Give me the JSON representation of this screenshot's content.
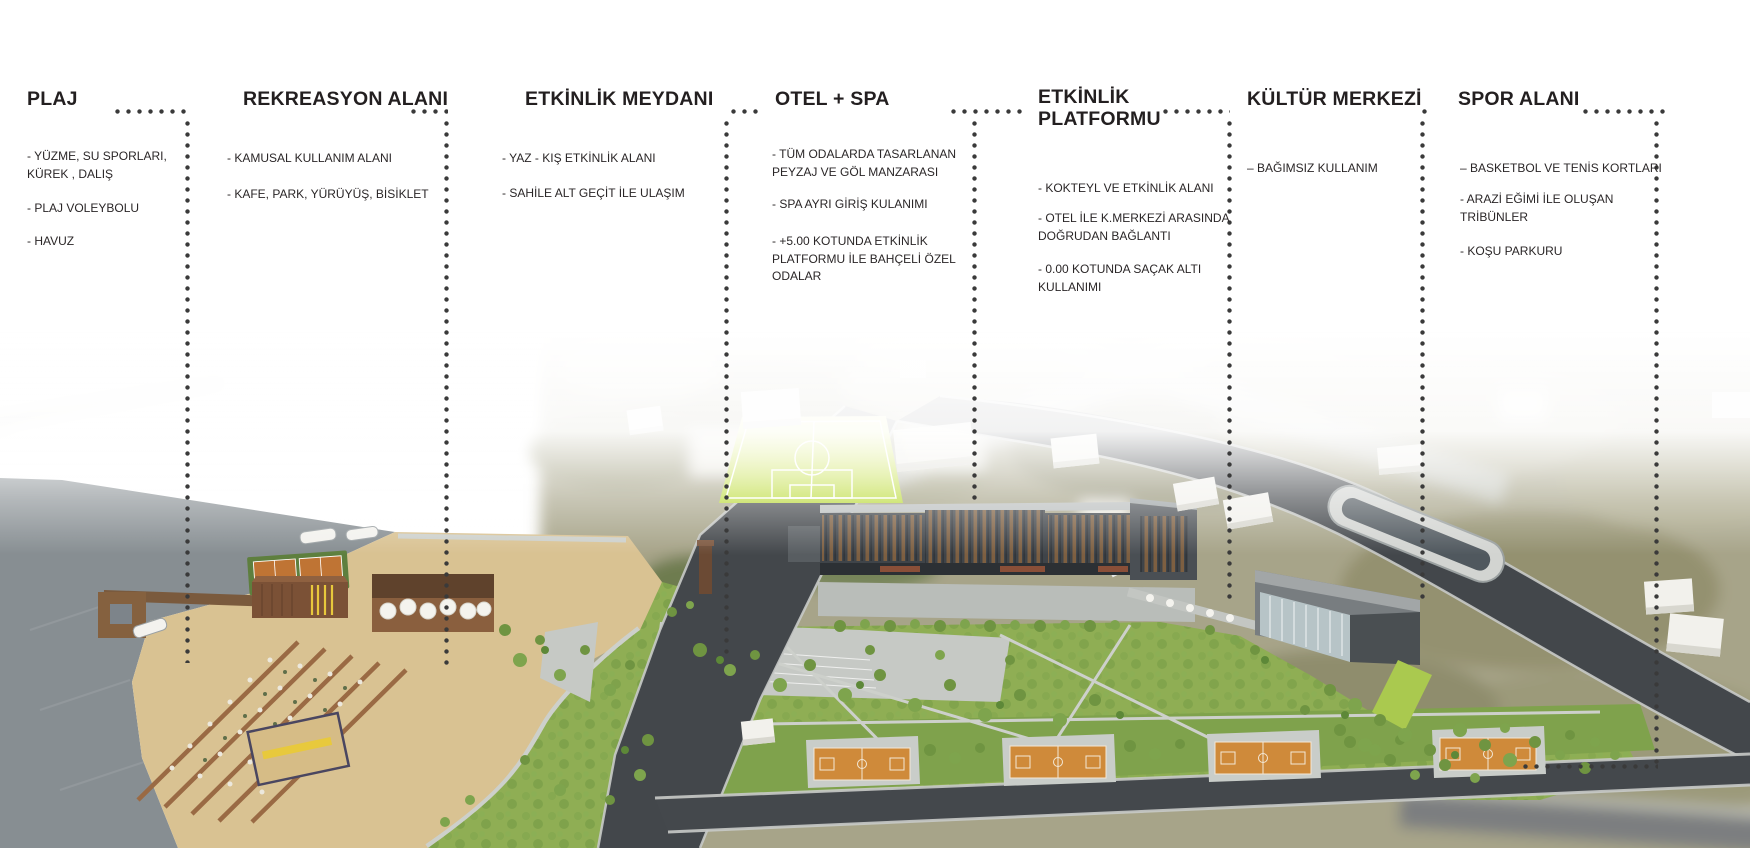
{
  "figure_type": "architectural-masterplan-diagram",
  "palette": {
    "text": "#231f20",
    "leader_dots": "#3a3a3a",
    "water": "#878e92",
    "sand": "#d9c292",
    "lawn": "#8fae54",
    "tree": "#6f9441",
    "road": "#43474b",
    "road_edge": "#c8cac8",
    "soccer_field": "#bfdb38",
    "court_orange": "#cf8a3a",
    "hotel_facade": "#3f4449",
    "hotel_windows": "#7d5f41",
    "culture_roof": "#9b9fa0",
    "white_building": "#f2f1ec",
    "plaza": "#c6c9c5",
    "deck_brown": "#8a5f3e",
    "terrain": "#a7a489"
  },
  "legend": {
    "sections": [
      {
        "title": "PLAJ",
        "items": [
          "- YÜZME, SU SPORLARI,\nKÜREK , DALIŞ",
          "- PLAJ VOLEYBOLU",
          "- HAVUZ"
        ]
      },
      {
        "title": "REKREASYON ALANI",
        "items": [
          "-  KAMUSAL KULLANIM ALANI",
          "- KAFE, PARK, YÜRÜYÜŞ, BİSİKLET"
        ]
      },
      {
        "title": "ETKİNLİK MEYDANI",
        "items": [
          "- YAZ - KIŞ ETKİNLİK ALANI",
          "- SAHİLE ALT GEÇİT İLE ULAŞIM"
        ]
      },
      {
        "title": "OTEL + SPA",
        "items": [
          "-  TÜM ODALARDA  TASARLANAN\nPEYZAJ VE GÖL MANZARASI",
          "- SPA AYRI GİRİŞ KULANIMI",
          "- +5.00 KOTUNDA ETKİNLİK\nPLATFORMU İLE BAHÇELİ ÖZEL\nODALAR"
        ]
      },
      {
        "title": "ETKİNLİK\nPLATFORMU",
        "items": [
          "- KOKTEYL VE ETKİNLİK ALANI",
          "- OTEL İLE K.MERKEZİ ARASINDA\nDOĞRUDAN BAĞLANTI",
          "- 0.00 KOTUNDA SAÇAK ALTI\nKULLANIMI"
        ]
      },
      {
        "title": "KÜLTÜR MERKEZİ",
        "items": [
          "– BAĞIMSIZ KULLANIM"
        ]
      },
      {
        "title": "SPOR ALANI",
        "items": [
          "– BASKETBOL VE TENİS KORTLARI",
          "- ARAZİ EĞİMİ İLE OLUŞAN\nTRİBÜNLER",
          "-  KOŞU PARKURU"
        ]
      }
    ]
  },
  "site": {
    "features": [
      "water",
      "marina-pier",
      "boats",
      "beach-sand",
      "sun-lounger-rows",
      "beach-volleyball-court",
      "tennis-courts",
      "beach-building",
      "cafe-terrace",
      "waterfront-promenade",
      "event-plaza",
      "main-road",
      "north-road",
      "south-road",
      "bus-stop-bay",
      "soccer-field",
      "hotel-building",
      "event-platform-walkway",
      "culture-center-building",
      "basketball-courts",
      "parks-and-trees",
      "background-terrain",
      "white-context-buildings"
    ]
  }
}
